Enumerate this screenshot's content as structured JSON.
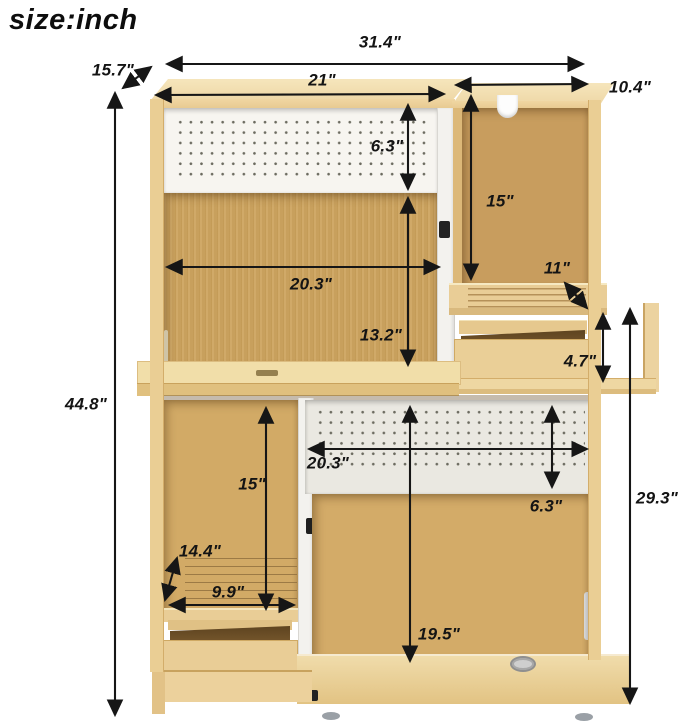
{
  "title": "size:inch",
  "dimensions": {
    "overall_width": "31.4\"",
    "top_depth": "15.7\"",
    "hutch_width": "21\"",
    "right_top_width": "10.4\"",
    "top_pegboard_height": "6.3\"",
    "right_compartment_height": "15\"",
    "right_shelf_depth": "11\"",
    "middle_width": "20.3\"",
    "middle_height": "13.2\"",
    "right_drawer_height": "4.7\"",
    "overall_height": "44.8\"",
    "lower_pegboard_width": "20.3\"",
    "lower_left_height": "15\"",
    "lower_pegboard_height": "6.3\"",
    "lower_right_height": "29.3\"",
    "lower_left_depth": "14.4\"",
    "lower_shelf_width": "9.9\"",
    "bottom_compartment_height": "19.5\""
  },
  "colors": {
    "wood_frame": "#ecd19c",
    "wood_back_panel": "#cda45f",
    "pegboard_top": "#f7f5f0",
    "pegboard_lower": "#eae8e1",
    "dimension_lines": "#161616",
    "background": "#ffffff"
  }
}
